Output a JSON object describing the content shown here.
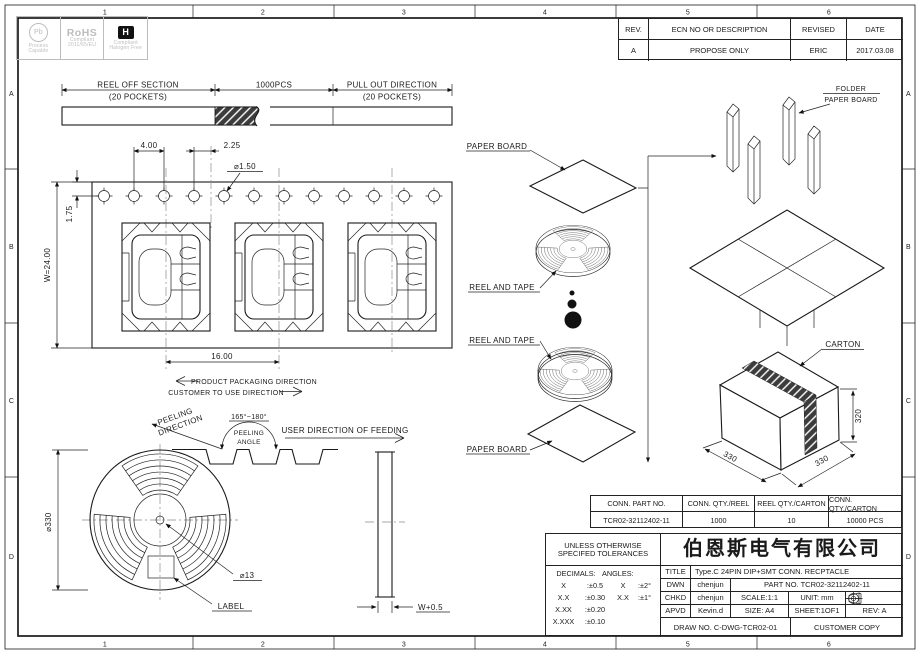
{
  "border": {
    "cols": [
      "1",
      "2",
      "3",
      "4",
      "5",
      "6"
    ],
    "rows": [
      "A",
      "B",
      "C",
      "D"
    ]
  },
  "logos": {
    "pb": "Pb",
    "pb_cap1": "Process",
    "pb_cap2": "Capable",
    "rohs1": "RoHS",
    "rohs2": "Compliant",
    "rohs3": "2011/65/EU",
    "hal": "H",
    "hal_cap1": "Compliant",
    "hal_cap2": "Halogen Free"
  },
  "revision": {
    "h": [
      "REV.",
      "ECN NO OR DESCRIPTION",
      "REVISED",
      "DATE"
    ],
    "r": [
      "A",
      "PROPOSE ONLY",
      "ERIC",
      "2017.03.08"
    ]
  },
  "reel_off": {
    "left": "REEL OFF SECTION",
    "left_sub": "(20 POCKETS)",
    "mid": "1000PCS",
    "right": "PULL OUT DIRECTION",
    "right_sub": "(20 POCKETS)"
  },
  "tape": {
    "pitch": "4.00",
    "offset": "2.25",
    "hole": "⌀1.50",
    "edge": "1.75",
    "width": "W=24.00",
    "pocket_pitch": "16.00",
    "pack_dir": "PRODUCT PACKAGING DIRECTION",
    "use_dir": "CUSTOMER TO USE DIRECTION"
  },
  "peel": {
    "dir1": "PEELING",
    "dir2": "DIRECTION",
    "angle": "165°~180°",
    "angle1": "PEELING",
    "angle2": "ANGLE",
    "feed": "USER DIRECTION OF FEEDING"
  },
  "reel": {
    "outer": "⌀330",
    "hub": "⌀13",
    "label": "LABEL",
    "side_width": "W+0.5"
  },
  "pack": {
    "paper_board": "PAPER BOARD",
    "reel_tape": "REEL AND TAPE",
    "folder1": "FOLDER",
    "folder2": "PAPER BOARD",
    "carton": "CARTON",
    "h": "320",
    "d1": "330",
    "d2": "330"
  },
  "qty": {
    "h": [
      "CONN. PART NO.",
      "CONN. QTY./REEL",
      "REEL QTY./CARTON",
      "CONN. QTY./CARTON"
    ],
    "r": [
      "TCR02-32112402-11",
      "1000",
      "10",
      "10000 PCS"
    ]
  },
  "tb": {
    "unless1": "UNLESS OTHERWISE",
    "unless2": "SPECIFED TOLERANCES",
    "dec": "DECIMALS:",
    "ang": "ANGLES:",
    "d": [
      [
        "X",
        ":±0.5"
      ],
      [
        "X.X",
        ":±0.30"
      ],
      [
        "X.XX",
        ":±0.20"
      ],
      [
        "X.XXX",
        ":±0.10"
      ]
    ],
    "a": [
      [
        "X",
        ":±2°"
      ],
      [
        "X.X",
        ":±1°"
      ]
    ],
    "company": "伯恩斯电气有限公司",
    "title_l": "TITLE",
    "title_v": "Type.C 24PIN DIP+SMT  CONN. RECPTACLE",
    "dwn_l": "DWN",
    "dwn_v": "chenjun",
    "part": "PART NO. TCR02-32112402-11",
    "chkd_l": "CHKD",
    "chkd_v": "chenjun",
    "scale": "SCALE:1:1",
    "unit": "UNIT:  mm",
    "apvd_l": "APVD",
    "apvd_v": "Kevin.d",
    "size": "SIZE: A4",
    "sheet": "SHEET:1OF1",
    "rev": "REV: A",
    "draw": "DRAW NO. C-DWG-TCR02-01",
    "copy": "CUSTOMER COPY"
  }
}
